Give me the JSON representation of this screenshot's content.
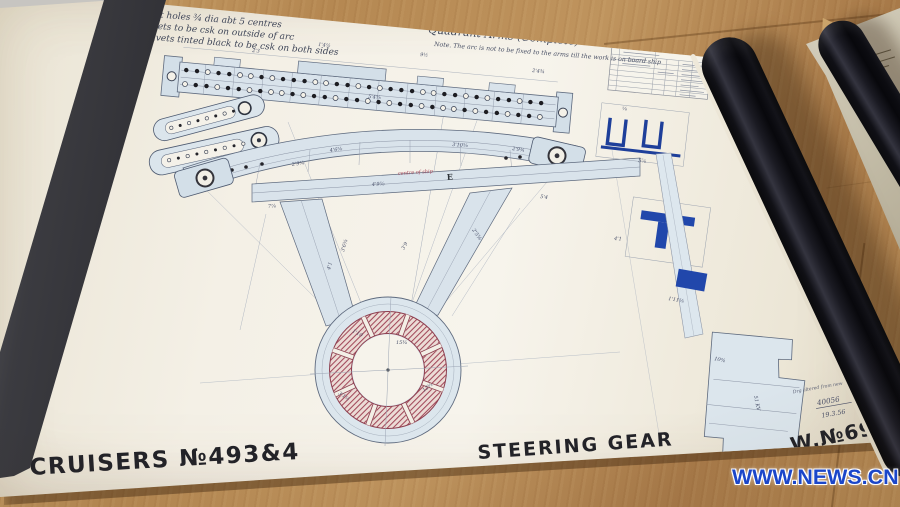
{
  "scene": {
    "watermark": "WWW.NEWS.CN",
    "colors": {
      "wood": "#b58852",
      "paper": "#f4f0e6",
      "ink": "#4a5268",
      "blue_tint": "#d9e3eb",
      "dark_blue": "#2147ab",
      "red_hatch": "#a2495a",
      "stencil": "#232328",
      "watermark_blue": "#1b46c9"
    }
  },
  "drawing": {
    "notes": [
      "Rivet holes ¾ dia abt 5 centres",
      "Rivets to be csk on outside of arc",
      "Rivets tinted black to be csk on both sides"
    ],
    "title": "Quadrant Arms (Complete)",
    "title_note": "Note. The arc is not to be fixed to the arms till the work is on board ship",
    "beam_label": "E",
    "red_note": "centre of ship",
    "stamp": {
      "line1": "Drg altered from new plan",
      "number": "40056",
      "date": "19.3.56"
    },
    "footer": {
      "left": "CRUISERS №493&4",
      "center": "STEERING GEAR",
      "right": "W.№690V"
    },
    "rivets": {
      "row1": "1101100101110011010111001101011011",
      "row2": "0110110100101101101011010010110110"
    },
    "dims": [
      {
        "t": "2'3",
        "x": 252,
        "y": 52,
        "r": 5
      },
      {
        "t": "1'4½",
        "x": 318,
        "y": 46,
        "r": 5
      },
      {
        "t": "9½",
        "x": 420,
        "y": 56,
        "r": 5
      },
      {
        "t": "2'4¾",
        "x": 532,
        "y": 72,
        "r": 6
      },
      {
        "t": "5'4⅝",
        "x": 368,
        "y": 98,
        "r": 5
      },
      {
        "t": "4'6⅝",
        "x": 330,
        "y": 152,
        "r": -8
      },
      {
        "t": "2'9¾",
        "x": 292,
        "y": 166,
        "r": -8
      },
      {
        "t": "3'10⅝",
        "x": 452,
        "y": 146,
        "r": 4
      },
      {
        "t": "2'9¾",
        "x": 512,
        "y": 150,
        "r": 8
      },
      {
        "t": "4'9⅝",
        "x": 372,
        "y": 186,
        "r": -3.5
      },
      {
        "t": "7⅞",
        "x": 268,
        "y": 208,
        "r": -4
      },
      {
        "t": "5'4",
        "x": 540,
        "y": 198,
        "r": 8
      },
      {
        "t": "3'6⅝",
        "x": 344,
        "y": 252,
        "r": -74
      },
      {
        "t": "4'1",
        "x": 330,
        "y": 270,
        "r": -74
      },
      {
        "t": "2'5⅜",
        "x": 472,
        "y": 230,
        "r": 56
      },
      {
        "t": "3'9",
        "x": 404,
        "y": 250,
        "r": -60
      },
      {
        "t": "1'10",
        "x": 352,
        "y": 332,
        "r": 28
      },
      {
        "t": "15¾",
        "x": 396,
        "y": 344,
        "r": 0
      },
      {
        "t": "12⅝",
        "x": 424,
        "y": 392,
        "r": -38
      },
      {
        "t": "3'1½",
        "x": 338,
        "y": 394,
        "r": 34
      },
      {
        "t": "⅝",
        "x": 622,
        "y": 110,
        "r": 6
      },
      {
        "t": "5⅞",
        "x": 638,
        "y": 162,
        "r": 6
      },
      {
        "t": "4'1",
        "x": 614,
        "y": 240,
        "r": 4
      },
      {
        "t": "1'11⅝",
        "x": 668,
        "y": 300,
        "r": 10
      },
      {
        "t": "10¾",
        "x": 714,
        "y": 360,
        "r": 12
      },
      {
        "t": "51 KV",
        "x": 754,
        "y": 396,
        "r": 78
      }
    ]
  }
}
